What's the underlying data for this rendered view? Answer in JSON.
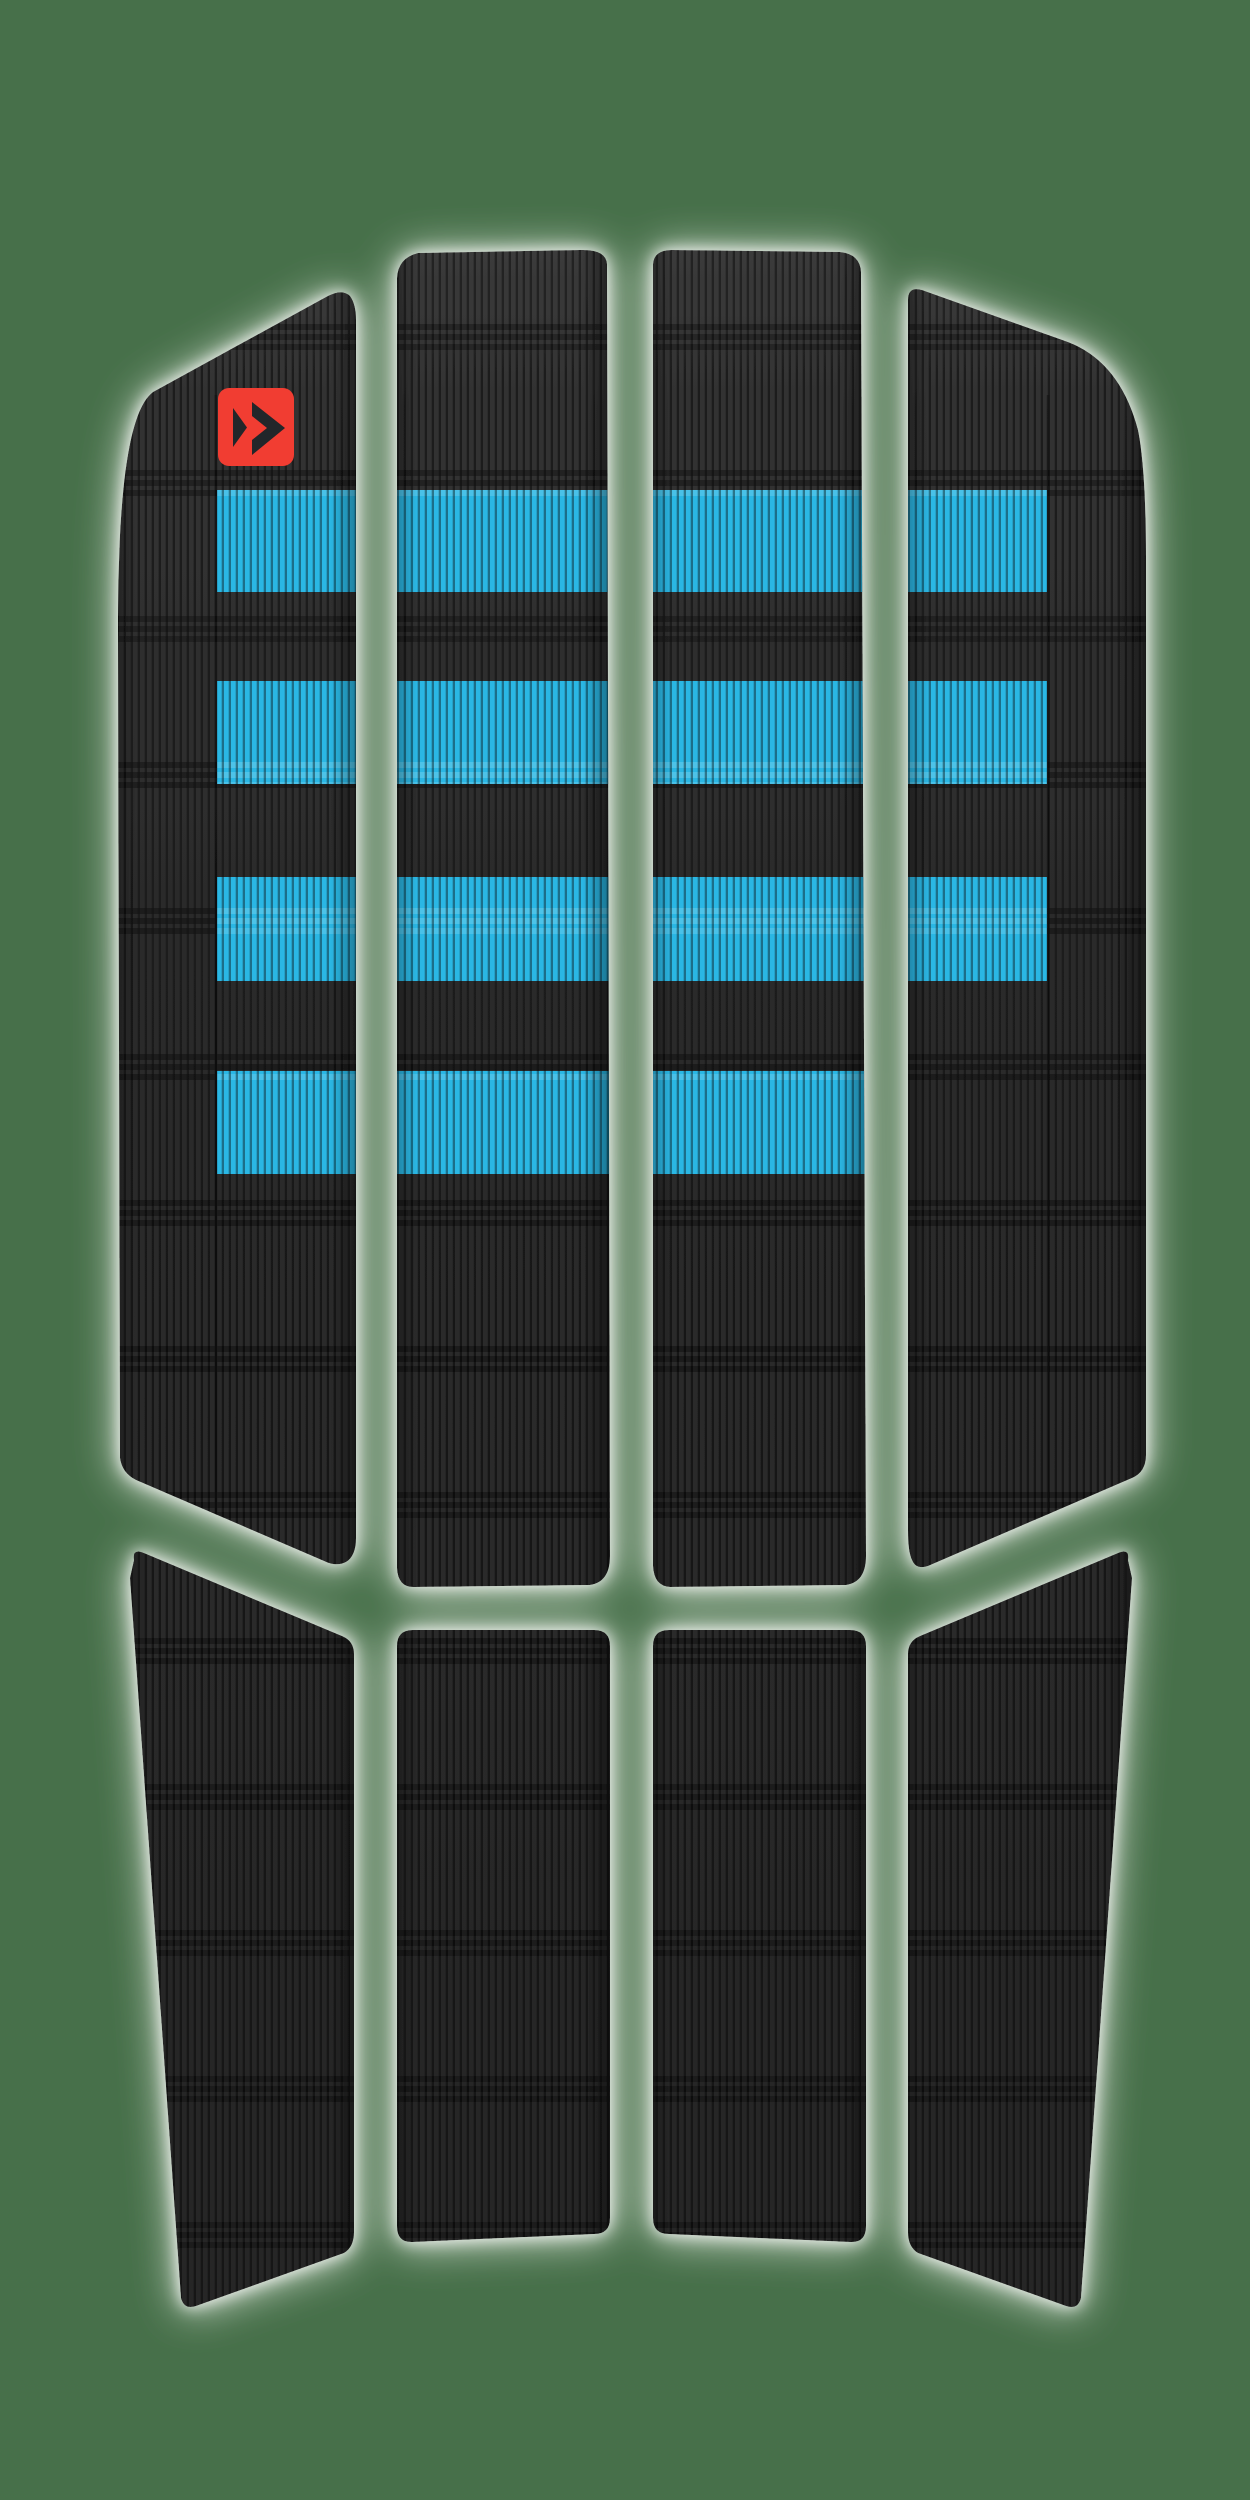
{
  "product": {
    "name": "front traction pad",
    "brand_icon": "duotone-arrow-logo"
  },
  "colors": {
    "background_green": "#47704a",
    "pad_black": "#2e2e2e",
    "pad_black_light": "#3a3a3a",
    "pad_black_deep": "#262626",
    "accent_blue": "#2bb7e4",
    "logo_red": "#f13c30",
    "logo_glyph_dark": "#23272b",
    "glow_white": "#ffffff"
  },
  "layout_counts": {
    "top_strips": "4",
    "bottom_strips": "4",
    "blue_band_rows": "4"
  }
}
